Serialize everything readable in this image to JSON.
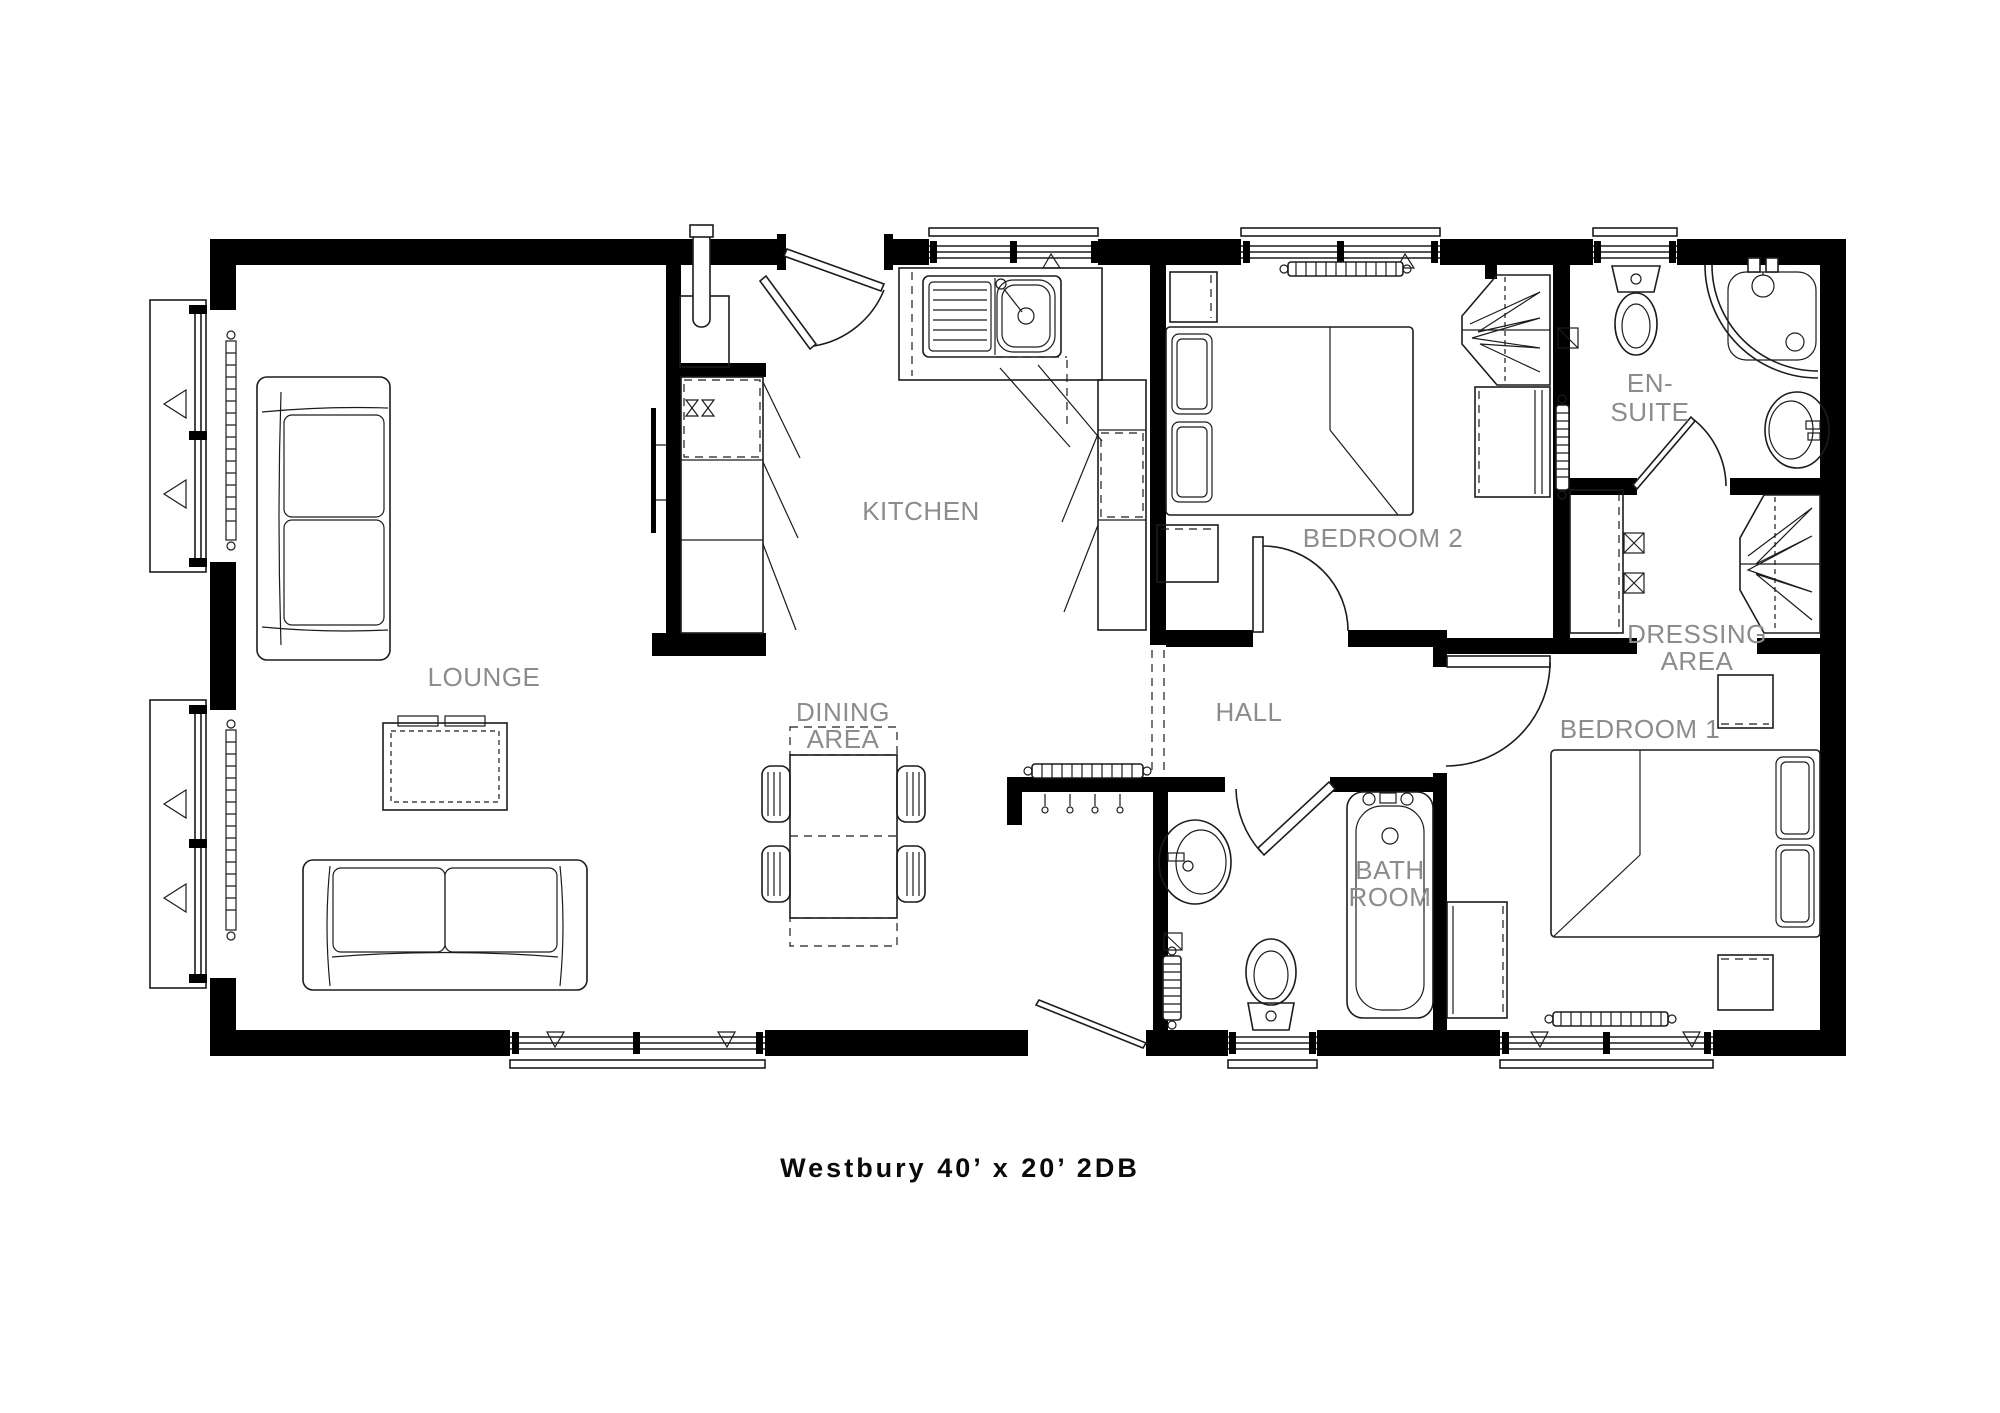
{
  "title": "Westbury 40’ x 20’ 2DB",
  "rooms": {
    "lounge": {
      "label": "LOUNGE"
    },
    "kitchen": {
      "label": "KITCHEN"
    },
    "dining": {
      "line1": "DINING",
      "line2": "AREA"
    },
    "hall": {
      "label": "HALL"
    },
    "bedroom2": {
      "label": "BEDROOM 2"
    },
    "ensuite": {
      "line1": "EN-",
      "line2": "SUITE"
    },
    "dressing": {
      "line1": "DRESSING",
      "line2": "AREA"
    },
    "bedroom1": {
      "label": "BEDROOM 1"
    },
    "bathroom": {
      "line1": "BATH",
      "line2": "ROOM"
    }
  },
  "colors": {
    "wall": "#000000",
    "outline": "#1c1c1c",
    "label": "#8c8c8c",
    "title": "#0a0a0a"
  }
}
